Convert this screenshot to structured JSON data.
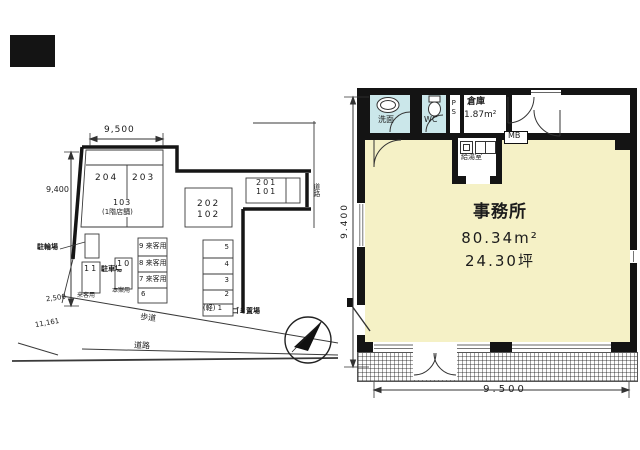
{
  "site_plan": {
    "dim_top": "9,500",
    "dim_left": "9,400",
    "dim_offset": "2,500",
    "dim_frontage": "11,161",
    "units": {
      "u204": "204",
      "u203": "203",
      "u103": "103",
      "u103_note": "(1階店舗)",
      "u202": "202",
      "u102": "102",
      "u201": "201",
      "u101": "101"
    },
    "labels": {
      "bicycle_parking": "駐輪場",
      "parking_lot": "駐車場",
      "garbage": "ゴミ置場",
      "walkway": "歩道",
      "road_bottom": "道路",
      "road_right": "道路"
    },
    "parking": {
      "no11": "11",
      "no11_use": "来客用",
      "no10": "10",
      "no10_use": "本案用",
      "rowA": [
        "9 来客用",
        "8 来客用",
        "7 来客用",
        "6"
      ],
      "rowB": [
        "5",
        "4",
        "3",
        "2",
        "(軽) 1"
      ]
    }
  },
  "floor_plan": {
    "office_name": "事務所",
    "office_area_m2": "80.34m²",
    "office_area_tsubo": "24.30坪",
    "washroom": "洗面",
    "wc": "WC",
    "ps": "PS",
    "storage": "倉庫",
    "storage_area": "1.87m²",
    "meter_box": "MB",
    "kitchenette": "給湯室",
    "dim_width": "9.500",
    "dim_height": "9.400"
  },
  "colors": {
    "office_fill": "#F5F1C6",
    "wet_area_fill": "#CBE7EA",
    "wall": "#141414"
  }
}
